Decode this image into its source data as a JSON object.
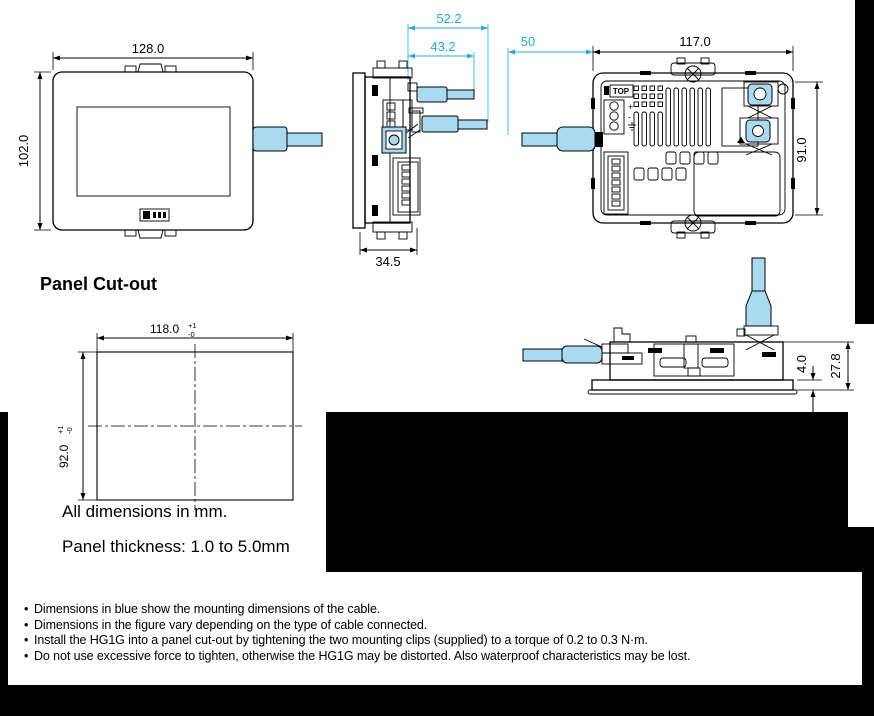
{
  "colors": {
    "dimension_blue": "#29A8DF",
    "cable_fill": "#A9DAEF",
    "ink": "#000000",
    "page_background": "#FFFFFF",
    "canvas_background": "#000000"
  },
  "views": {
    "front": {
      "dims": {
        "width": "128.0",
        "height": "102.0"
      }
    },
    "side": {
      "dims": {
        "cable_clearance_total": "52.2",
        "cable_clearance": "43.2",
        "depth": "34.5"
      }
    },
    "rear": {
      "top_marking": "TOP",
      "terminal_plus": "+",
      "terminal_minus": "-",
      "dims": {
        "cable_bend_clearance": "50",
        "width": "117.0",
        "height": "91.0"
      }
    },
    "bottom": {
      "dims": {
        "bezel_thickness": "4.0",
        "depth_behind_panel": "27.8"
      }
    }
  },
  "panel_cutout": {
    "title": "Panel Cut-out",
    "dims": {
      "width": {
        "value": "118.0",
        "tol_plus": "+1",
        "tol_minus": "-0"
      },
      "height": {
        "value": "92.0",
        "tol_plus": "+1",
        "tol_minus": "-0"
      }
    },
    "units_note": "All dimensions in mm.",
    "thickness_note": "Panel thickness: 1.0 to 5.0mm"
  },
  "notes": {
    "items": [
      "Dimensions in blue show the mounting dimensions of the cable.",
      "Dimensions in the figure vary depending on the type of cable connected.",
      "Install the HG1G into a panel cut-out by tightening the two mounting clips (supplied) to a torque of 0.2 to 0.3 N·m.",
      "Do not use excessive force to tighten, otherwise the HG1G may be distorted. Also waterproof characteristics may be lost."
    ]
  }
}
